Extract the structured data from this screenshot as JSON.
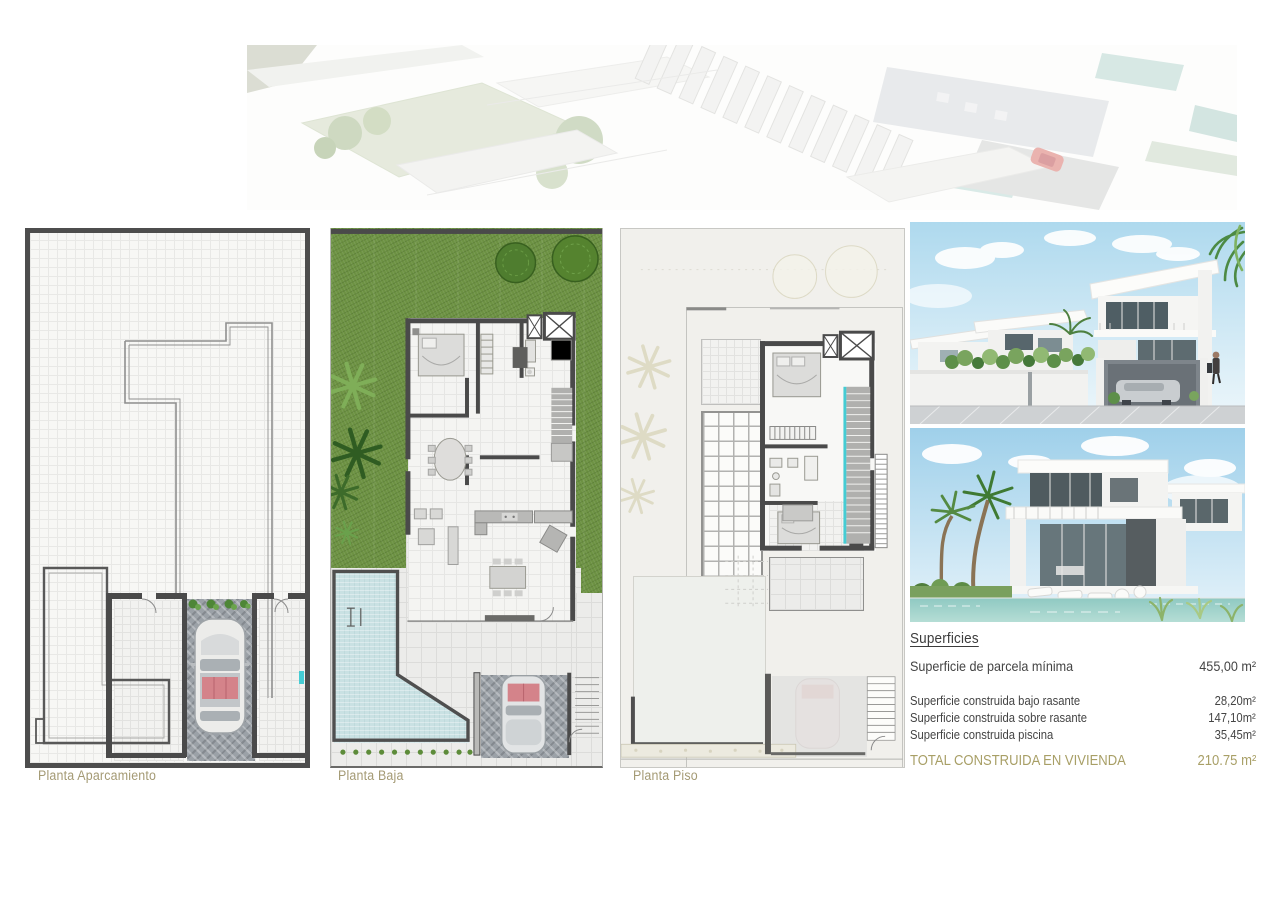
{
  "plans": [
    {
      "label": "Planta Aparcamiento"
    },
    {
      "label": "Planta Baja"
    },
    {
      "label": "Planta Piso"
    }
  ],
  "superficies": {
    "title": "Superficies",
    "parcela": {
      "label": "Superficie de parcela mínima",
      "value": "455,00 m²"
    },
    "rows": [
      {
        "label": "Superficie construida bajo rasante",
        "value": "28,20m²"
      },
      {
        "label": "Superficie construida sobre rasante",
        "value": "147,10m²"
      },
      {
        "label": "Superficie construida piscina",
        "value": "35,45m²"
      }
    ],
    "total": {
      "label": "TOTAL CONSTRUIDA EN VIVIENDA",
      "value": "210.75 m²"
    }
  },
  "colors": {
    "accent_gold_labels": "#a49a74",
    "accent_gold_total": "#a89f66",
    "wall_dark": "#4a4a4a",
    "grass_green": "#6d9243",
    "pool_blue": "#c9e1e3",
    "stair_teal": "#45ccd3",
    "text_dark": "#3c3c3c",
    "render_sky": "#b7ddee"
  }
}
